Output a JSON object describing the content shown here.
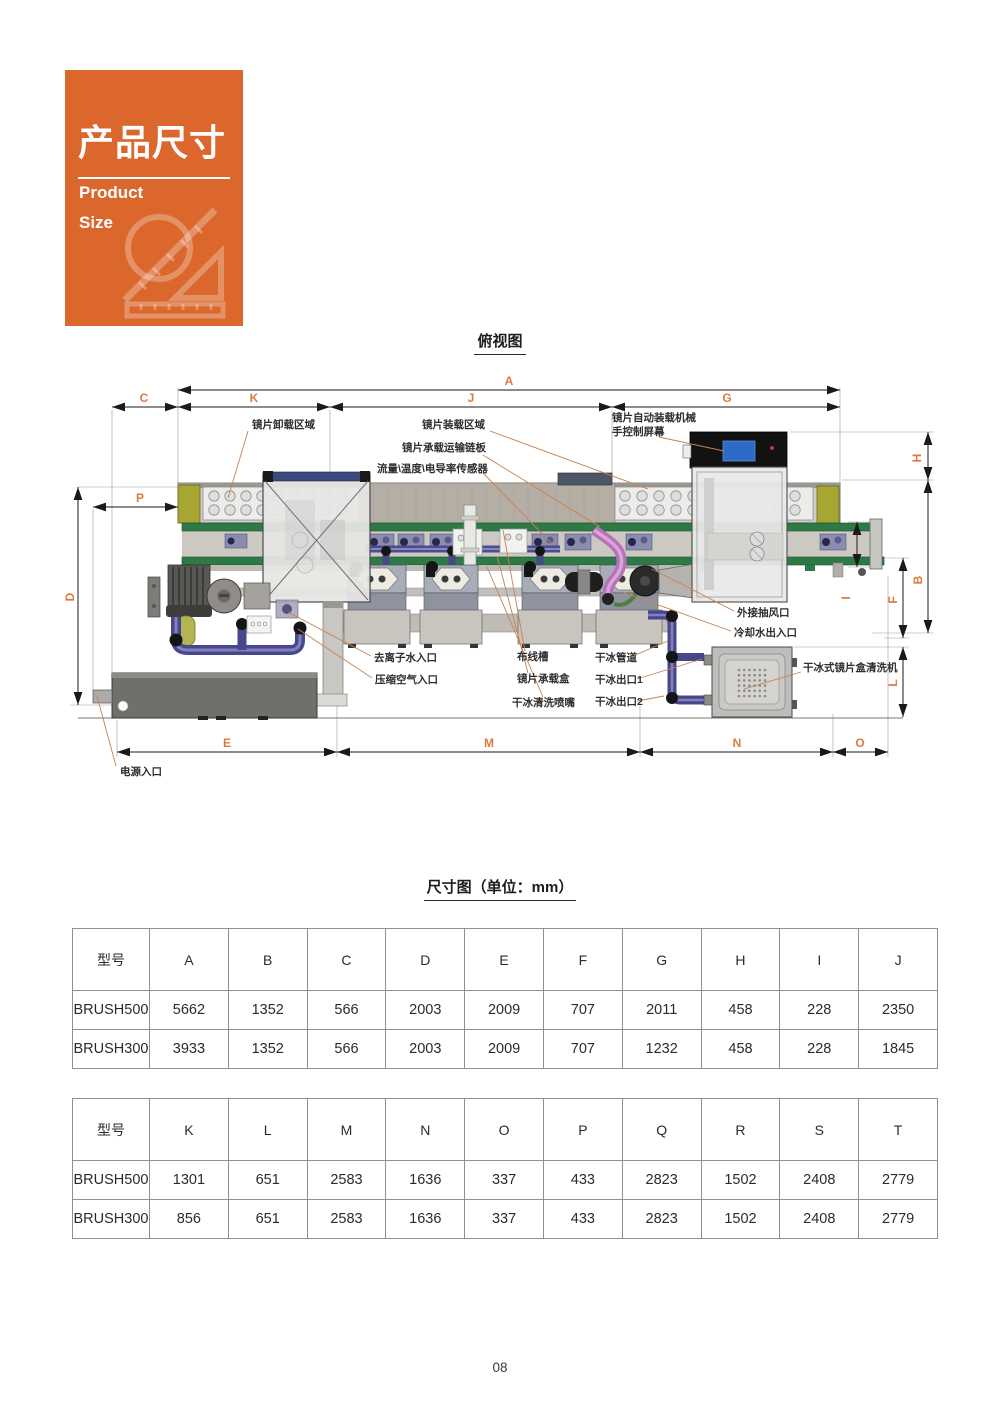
{
  "page": {
    "number": "08"
  },
  "card": {
    "title": "产品尺寸",
    "subtitle_line1": "Product",
    "subtitle_line2": "Size"
  },
  "figure": {
    "title": "俯视图",
    "dims": {
      "a": "A",
      "b": "B",
      "c": "C",
      "d": "D",
      "e": "E",
      "f": "F",
      "g": "G",
      "h": "H",
      "i": "I",
      "j": "J",
      "k": "K",
      "l": "L",
      "m": "M",
      "n": "N",
      "o": "O",
      "p": "P"
    },
    "labels": {
      "unload_area": "镜片卸载区域",
      "load_area": "镜片装载区域",
      "chain_plate": "镜片承载运输链板",
      "sensor": "流量\\温度\\电导率传感器",
      "robot_line1": "镜片自动装载机械",
      "robot_line2": "手控制屏幕",
      "exhaust": "外接抽风口",
      "cooling_water": "冷却水出入口",
      "di_water": "去离子水入口",
      "compressed_air": "压缩空气入口",
      "cable_tray": "布线槽",
      "lens_box": "镜片承载盒",
      "ice_nozzle": "干冰清洗喷嘴",
      "ice_pipe": "干冰管道",
      "ice_outlet1": "干冰出口1",
      "ice_outlet2": "干冰出口2",
      "ice_cleaner": "干冰式镜片盒清洗机",
      "power_inlet": "电源入口"
    }
  },
  "size_table_section": {
    "title": "尺寸图（单位：mm）"
  },
  "table1": {
    "col_model": "型号",
    "headers": [
      "A",
      "B",
      "C",
      "D",
      "E",
      "F",
      "G",
      "H",
      "I",
      "J"
    ],
    "rows": [
      {
        "model": "BRUSH500",
        "values": [
          "5662",
          "1352",
          "566",
          "2003",
          "2009",
          "707",
          "2011",
          "458",
          "228",
          "2350"
        ]
      },
      {
        "model": "BRUSH300",
        "values": [
          "3933",
          "1352",
          "566",
          "2003",
          "2009",
          "707",
          "1232",
          "458",
          "228",
          "1845"
        ]
      }
    ]
  },
  "table2": {
    "col_model": "型号",
    "headers": [
      "K",
      "L",
      "M",
      "N",
      "O",
      "P",
      "Q",
      "R",
      "S",
      "T"
    ],
    "rows": [
      {
        "model": "BRUSH500",
        "values": [
          "1301",
          "651",
          "2583",
          "1636",
          "337",
          "433",
          "2823",
          "1502",
          "2408",
          "2779"
        ]
      },
      {
        "model": "BRUSH300",
        "values": [
          "856",
          "651",
          "2583",
          "1636",
          "337",
          "433",
          "2823",
          "1502",
          "2408",
          "2779"
        ]
      }
    ]
  },
  "colors": {
    "accent_orange": "#DC672C",
    "dim_letter_orange": "#DE7A3E",
    "leader_line": "#C8814F"
  }
}
